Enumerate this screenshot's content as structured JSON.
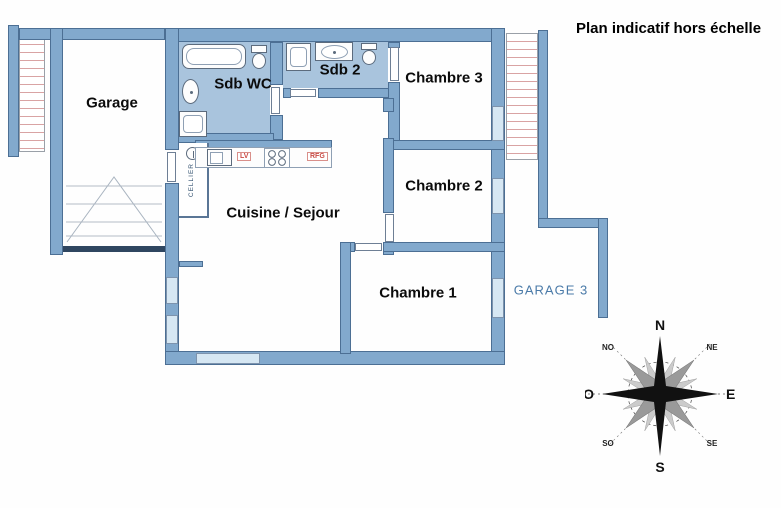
{
  "note": {
    "text": "Plan indicatif hors échelle"
  },
  "rooms": {
    "garage": {
      "label": "Garage"
    },
    "sdb_wc": {
      "label": "Sdb WC"
    },
    "sdb_2": {
      "label": "Sdb 2"
    },
    "chambre_3": {
      "label": "Chambre 3"
    },
    "chambre_2": {
      "label": "Chambre 2"
    },
    "chambre_1": {
      "label": "Chambre 1"
    },
    "cuisine_sejour": {
      "label": "Cuisine / Sejour"
    },
    "garage_3": {
      "label": "GARAGE 3"
    },
    "cellier": {
      "label": "CELLIER"
    }
  },
  "kitchen": {
    "dishwasher_label": "LV",
    "fridge_label": "RFG"
  },
  "fixtures": {
    "icons": [
      "bathtub-icon",
      "toilet-icon",
      "washbasin-icon",
      "shower-icon",
      "kitchen-sink-icon",
      "cooktop-icon",
      "water-heater-icon",
      "garage-door-icon"
    ]
  },
  "compass": {
    "n": "N",
    "s": "S",
    "e": "E",
    "o": "O",
    "no": "NO",
    "ne": "NE",
    "so": "SO",
    "se": "SE"
  },
  "colors": {
    "wall": "#82a9cd",
    "wall_outline": "#4c6f94",
    "bath_floor": "#a9c4dd",
    "window": "#d6e7f3",
    "hatch_line": "#d9a3a3",
    "blue_label": "#4a7aa8",
    "appliance_red": "#c94b45",
    "compass_black": "#111111",
    "compass_gray": "#9a9a9a"
  }
}
